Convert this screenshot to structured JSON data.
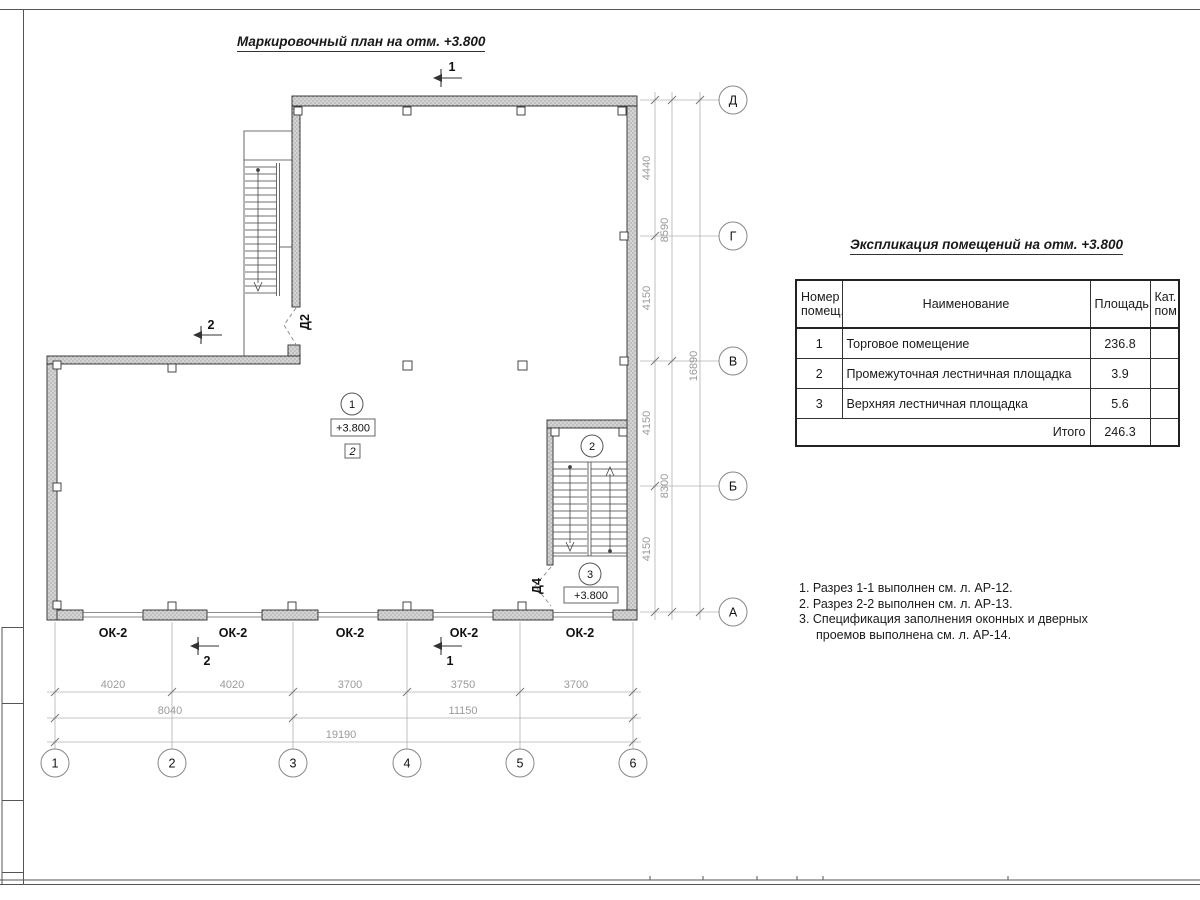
{
  "sheet": {
    "plan_title": "Маркировочный план на отм. +3.800"
  },
  "plan": {
    "elevation": "+3.800",
    "floor_type_marker": "2",
    "rooms": [
      "1",
      "2",
      "3"
    ],
    "doors": {
      "d2": "Д2",
      "d4": "Д4"
    },
    "window_mark": "ОК-2",
    "sections": {
      "top": "1",
      "left": "2",
      "bottom_left": "2",
      "bottom_right": "1"
    },
    "axes_letters": [
      "Д",
      "Г",
      "В",
      "Б",
      "А"
    ],
    "axes_numbers": [
      "1",
      "2",
      "3",
      "4",
      "5",
      "6"
    ],
    "dims_right1": [
      "4440",
      "4150",
      "4150",
      "4150"
    ],
    "dims_right2": [
      "8590",
      "8300"
    ],
    "dim_right_total": "16890",
    "dims_bottom1": [
      "4020",
      "4020",
      "3700",
      "3750",
      "3700"
    ],
    "dims_bottom2": [
      "8040",
      "11150"
    ],
    "dim_bottom_total": "19190"
  },
  "table": {
    "title": "Экспликация помещений на отм. +3.800",
    "headers": {
      "num1": "Номер",
      "num2": "помещ.",
      "name": "Наименование",
      "area": "Площадь",
      "cat1": "Кат.",
      "cat2": "пом."
    },
    "rows": [
      {
        "num": "1",
        "name": "Торговое помещение",
        "area": "236.8",
        "cat": ""
      },
      {
        "num": "2",
        "name": "Промежуточная лестничная площадка",
        "area": "3.9",
        "cat": ""
      },
      {
        "num": "3",
        "name": "Верхняя лестничная площадка",
        "area": "5.6",
        "cat": ""
      }
    ],
    "total_label": "Итого",
    "total_value": "246.3"
  },
  "notes": {
    "n1": "1. Разрез 1-1 выполнен см. л. АР-12.",
    "n2": "2. Разрез 2-2 выполнен см. л. АР-13.",
    "n3a": "3. Спецификация заполнения оконных и дверных",
    "n3b": "проемов выполнена см. л. АР-14."
  }
}
